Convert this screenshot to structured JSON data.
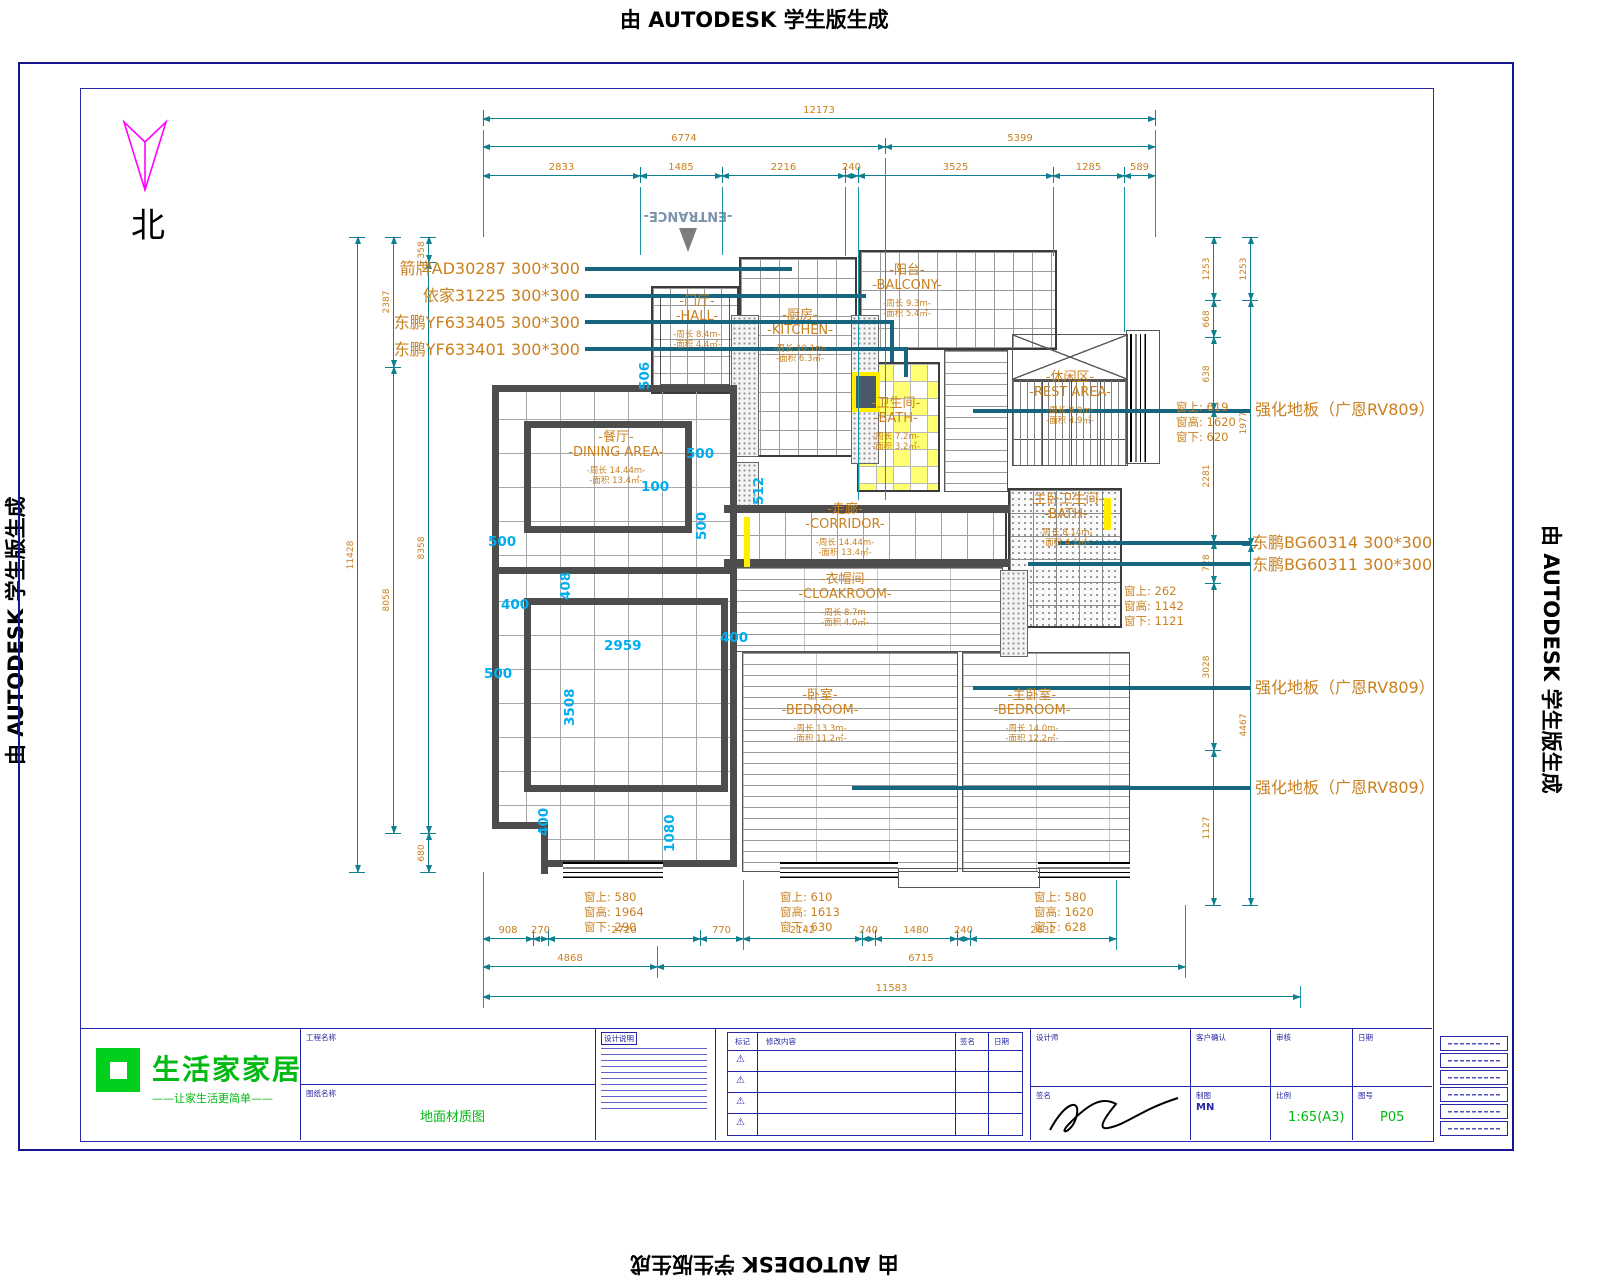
{
  "watermark": {
    "text": "由 AUTODESK 学生版生成"
  },
  "compass": {
    "label": "北"
  },
  "entrance": {
    "label": "-ENTRANCE-"
  },
  "colors": {
    "dim_line": "#0e7f8f",
    "dim_text": "#c9801f",
    "cyan": "#00aeef",
    "leader": "#17657e",
    "wall": "#4d4d4d",
    "frame": "#16168e",
    "accent_green": "#00b912",
    "north_arrow": "#ff00ff"
  },
  "tile_specs_left": [
    {
      "x": 580,
      "y": 255,
      "text": "箭牌AD30287  300*300"
    },
    {
      "x": 580,
      "y": 282,
      "text": "依家31225  300*300"
    },
    {
      "x": 580,
      "y": 309,
      "text": "东鹏YF633405  300*300"
    },
    {
      "x": 580,
      "y": 336,
      "text": "东鹏YF633401  300*300"
    }
  ],
  "specs_right": [
    {
      "x": 1255,
      "y": 396,
      "text": "强化地板（广恩RV809）"
    },
    {
      "x": 1252,
      "y": 529,
      "text": "东鹏BG60314  300*300"
    },
    {
      "x": 1252,
      "y": 551,
      "text": "东鹏BG60311  300*300"
    },
    {
      "x": 1255,
      "y": 674,
      "text": "强化地板（广恩RV809）"
    },
    {
      "x": 1255,
      "y": 774,
      "text": "强化地板（广恩RV809）"
    }
  ],
  "window_specs": [
    {
      "x": 1176,
      "y": 400,
      "lines": [
        "窗上: 619",
        "窗高: 1620",
        "窗下: 620"
      ]
    },
    {
      "x": 1124,
      "y": 584,
      "lines": [
        "窗上: 262",
        "窗高: 1142",
        "窗下: 1121"
      ]
    },
    {
      "x": 584,
      "y": 890,
      "lines": [
        "窗上: 580",
        "窗高: 1964",
        "窗下: 290"
      ]
    },
    {
      "x": 780,
      "y": 890,
      "lines": [
        "窗上: 610",
        "窗高: 1613",
        "窗下: 630"
      ]
    },
    {
      "x": 1034,
      "y": 890,
      "lines": [
        "窗上: 580",
        "窗高: 1620",
        "窗下: 628"
      ]
    }
  ],
  "rooms": [
    {
      "id": "hall",
      "x": 697,
      "y": 322,
      "cn": "-门厅-",
      "en": "-HALL-",
      "sub1": "-周长 8.4m-",
      "sub2": "-面积 4.4㎡-"
    },
    {
      "id": "kitchen",
      "x": 800,
      "y": 336,
      "cn": "-厨房-",
      "en": "-KITCHEN-",
      "sub1": "-周长 10.1m-",
      "sub2": "-面积 6.3㎡-"
    },
    {
      "id": "balcony",
      "x": 907,
      "y": 291,
      "cn": "-阳台-",
      "en": "-BALCONY-",
      "sub1": "-周长 9.3m-",
      "sub2": "-面积 5.4㎡-"
    },
    {
      "id": "bath",
      "x": 896,
      "y": 424,
      "cn": "-卫生间-",
      "en": "-BATH-",
      "sub1": "-周长 7.2m-",
      "sub2": "-面积 3.2㎡-"
    },
    {
      "id": "rest",
      "x": 1070,
      "y": 398,
      "cn": "-休闲区-",
      "en": "-REST AREA-",
      "sub1": "-周长 8.9m-",
      "sub2": "-面积 4.9㎡-"
    },
    {
      "id": "mbath",
      "x": 1066,
      "y": 520,
      "cn": "-主卧卫生间-",
      "en": "-BATH-",
      "sub1": "-周长 8.14m-",
      "sub2": "-面积 4.1㎡-"
    },
    {
      "id": "dining",
      "x": 616,
      "y": 458,
      "cn": "-餐厅-",
      "en": "-DINING AREA-",
      "sub1": "-周长 14.44m-",
      "sub2": "-面积 13.4㎡-"
    },
    {
      "id": "corridor",
      "x": 845,
      "y": 530,
      "cn": "-走廊-",
      "en": "-CORRIDOR-",
      "sub1": "-周长 14.44m-",
      "sub2": "-面积 13.4㎡-"
    },
    {
      "id": "cloak",
      "x": 845,
      "y": 600,
      "cn": "-衣帽间-",
      "en": "-CLOAKROOM-",
      "sub1": "-周长 8.7m-",
      "sub2": "-面积 4.0㎡-"
    },
    {
      "id": "bedroom",
      "x": 820,
      "y": 716,
      "cn": "-卧室-",
      "en": "-BEDROOM-",
      "sub1": "-周长 13.3m-",
      "sub2": "-面积 11.2㎡-"
    },
    {
      "id": "mbedroom",
      "x": 1032,
      "y": 716,
      "cn": "-主卧室-",
      "en": "-BEDROOM-",
      "sub1": "-周长 14.0m-",
      "sub2": "-面积 12.2㎡-"
    }
  ],
  "cyan_marks": [
    {
      "t": "506",
      "x": 637,
      "y": 390,
      "r": 1
    },
    {
      "t": "500",
      "x": 686,
      "y": 446
    },
    {
      "t": "100",
      "x": 641,
      "y": 479
    },
    {
      "t": "512",
      "x": 751,
      "y": 505,
      "r": 1
    },
    {
      "t": "500",
      "x": 488,
      "y": 534
    },
    {
      "t": "500",
      "x": 694,
      "y": 540,
      "r": 1
    },
    {
      "t": "400",
      "x": 501,
      "y": 597
    },
    {
      "t": "408",
      "x": 558,
      "y": 600,
      "r": 1
    },
    {
      "t": "400",
      "x": 720,
      "y": 630
    },
    {
      "t": "2959",
      "x": 604,
      "y": 638
    },
    {
      "t": "500",
      "x": 484,
      "y": 666
    },
    {
      "t": "3508",
      "x": 562,
      "y": 726,
      "r": 1
    },
    {
      "t": "400",
      "x": 536,
      "y": 836,
      "r": 1
    },
    {
      "t": "1080",
      "x": 662,
      "y": 852,
      "r": 1
    }
  ],
  "dims": {
    "h": [
      {
        "y": 118,
        "segs": [
          [
            483,
            1155,
            "12173"
          ]
        ]
      },
      {
        "y": 146,
        "segs": [
          [
            483,
            885,
            "6774"
          ],
          [
            885,
            1155,
            "5399"
          ]
        ]
      },
      {
        "y": 175,
        "segs": [
          [
            483,
            640,
            "2833"
          ],
          [
            640,
            722,
            "1485"
          ],
          [
            722,
            845,
            "2216"
          ],
          [
            845,
            858,
            "240"
          ],
          [
            858,
            1053,
            "3525"
          ],
          [
            1053,
            1124,
            "1285"
          ],
          [
            1124,
            1155,
            "589"
          ]
        ]
      },
      {
        "y": 938,
        "segs": [
          [
            483,
            533,
            "908"
          ],
          [
            533,
            548,
            "270"
          ],
          [
            548,
            700,
            "2720"
          ],
          [
            700,
            743,
            "770"
          ],
          [
            743,
            862,
            "2142"
          ],
          [
            862,
            875,
            "240"
          ],
          [
            875,
            957,
            "1480"
          ],
          [
            957,
            970,
            "240"
          ],
          [
            970,
            1116,
            "2632"
          ]
        ]
      },
      {
        "y": 966,
        "segs": [
          [
            483,
            657,
            "4868"
          ],
          [
            657,
            1185,
            "6715"
          ]
        ]
      },
      {
        "y": 996,
        "segs": [
          [
            483,
            1300,
            "11583"
          ]
        ]
      }
    ],
    "v": [
      {
        "x": 357,
        "segs": [
          [
            237,
            872,
            "11428"
          ]
        ]
      },
      {
        "x": 393,
        "segs": [
          [
            237,
            367,
            "2387"
          ],
          [
            367,
            833,
            "8058"
          ]
        ]
      },
      {
        "x": 428,
        "segs": [
          [
            237,
            262,
            "358"
          ],
          [
            262,
            833,
            "8358"
          ],
          [
            833,
            872,
            "680"
          ]
        ]
      },
      {
        "x": 1213,
        "segs": [
          [
            237,
            300,
            "1253"
          ],
          [
            300,
            337,
            "668"
          ],
          [
            337,
            410,
            "638"
          ],
          [
            410,
            542,
            "2281"
          ],
          [
            542,
            583,
            "728"
          ],
          [
            583,
            750,
            "3028"
          ],
          [
            750,
            905,
            "1127"
          ]
        ]
      },
      {
        "x": 1250,
        "segs": [
          [
            237,
            300,
            "1253"
          ],
          [
            300,
            545,
            "1977"
          ],
          [
            545,
            905,
            "4467"
          ]
        ]
      }
    ]
  },
  "ext_lines": [
    {
      "x": 483,
      "y1": 130,
      "y2": 237
    },
    {
      "x": 1155,
      "y1": 130,
      "y2": 237
    },
    {
      "x": 640,
      "y1": 187,
      "y2": 255
    },
    {
      "x": 722,
      "y1": 187,
      "y2": 255
    },
    {
      "x": 845,
      "y1": 187,
      "y2": 256
    },
    {
      "x": 858,
      "y1": 187,
      "y2": 500
    },
    {
      "x": 885,
      "y1": 158,
      "y2": 500
    },
    {
      "x": 1053,
      "y1": 187,
      "y2": 256
    },
    {
      "x": 1124,
      "y1": 187,
      "y2": 332
    },
    {
      "x": 483,
      "y1": 872,
      "y2": 1008
    },
    {
      "x": 657,
      "y1": 946,
      "y2": 978
    },
    {
      "x": 743,
      "y1": 880,
      "y2": 950
    },
    {
      "x": 1116,
      "y1": 880,
      "y2": 950
    },
    {
      "x": 1185,
      "y1": 905,
      "y2": 978
    },
    {
      "x": 1300,
      "y1": 986,
      "y2": 1008
    }
  ],
  "leaders": [
    {
      "x1": 585,
      "y": 269,
      "x2": 792
    },
    {
      "x1": 585,
      "y": 296,
      "x2": 866
    },
    {
      "x1": 585,
      "y": 322,
      "x2": 894,
      "drop": 362
    },
    {
      "x1": 585,
      "y": 349,
      "x2": 908,
      "drop": 377
    },
    {
      "x1": 973,
      "y": 411,
      "x2": 1250
    },
    {
      "x1": 1058,
      "y": 543,
      "x2": 1250
    },
    {
      "x1": 1028,
      "y": 564,
      "x2": 1250
    },
    {
      "x1": 973,
      "y": 688,
      "x2": 1250
    },
    {
      "x1": 852,
      "y": 788,
      "x2": 1250
    }
  ],
  "titleblock": {
    "logo_title": "生活家家居",
    "logo_tagline": "——让家生活更简单——",
    "project_label": "工程名称",
    "drawing_label": "图纸名称",
    "drawing_value": "地面材质图",
    "notes_title": "设计说明",
    "rev_headers": [
      "标记",
      "修改内容",
      "签名",
      "日期"
    ],
    "designer_label": "设计师",
    "sign_label": "签名",
    "client_label": "客户确认",
    "draft_label": "制图",
    "draft_value": "MN",
    "check_label": "审核",
    "scale_label": "比例",
    "scale_value": "1:65(A3)",
    "date_label": "日期",
    "sheet_label": "图号",
    "sheet_value": "P05"
  }
}
